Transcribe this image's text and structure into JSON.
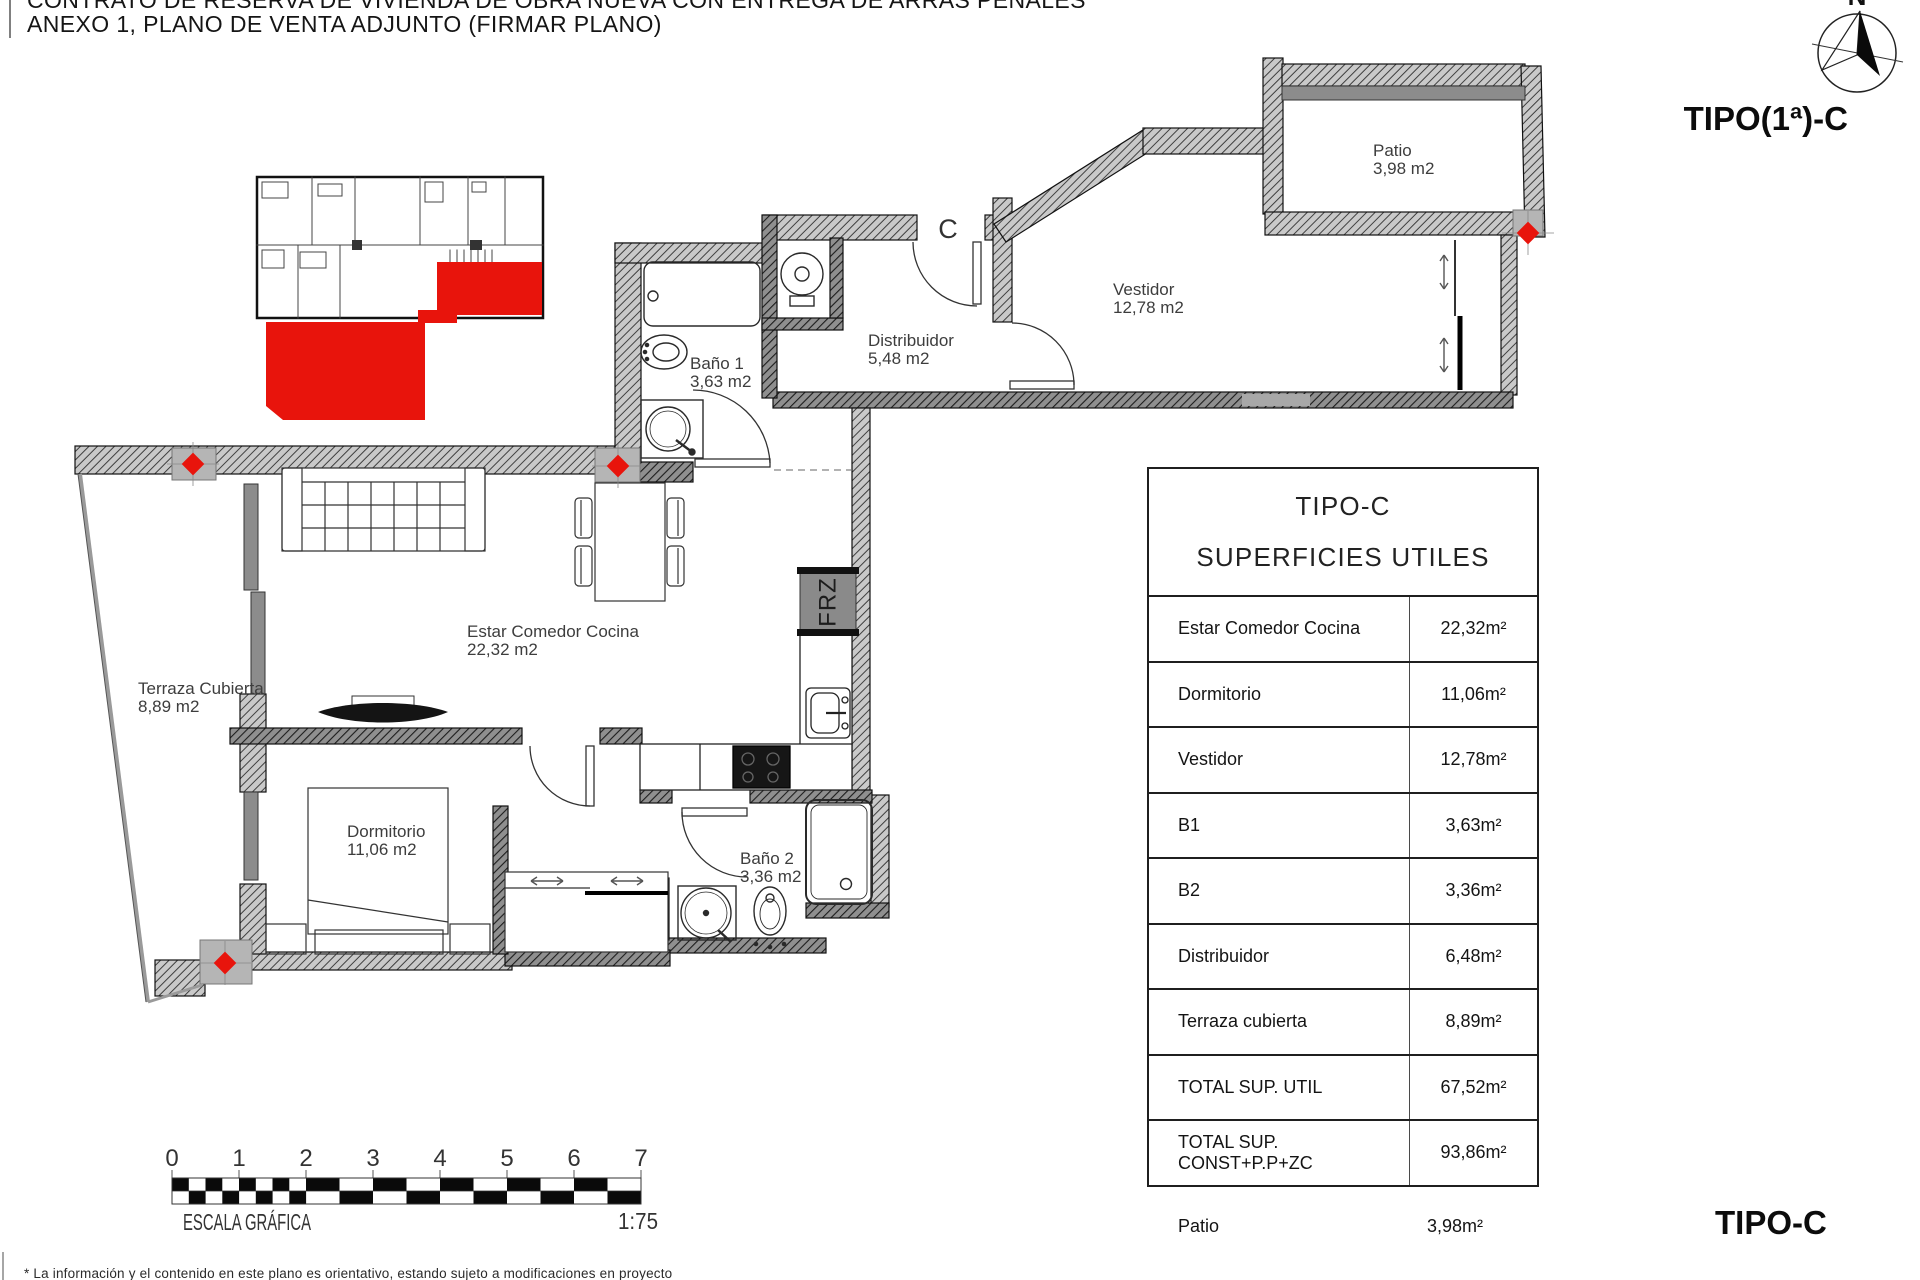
{
  "header": {
    "line1": "CONTRATO DE RESERVA DE VIVIENDA DE OBRA NUEVA CON ENTREGA DE ARRAS PENALES",
    "line2": "ANEXO 1, PLANO DE VENTA ADJUNTO (FIRMAR PLANO)"
  },
  "compass": {
    "north_label": "N"
  },
  "plan": {
    "type_label_top": "TIPO(1ª)-C",
    "type_label_bottom": "TIPO-C",
    "entrance_door_label": "C",
    "fridge_label": "FRZ",
    "rooms": [
      {
        "name": "Patio",
        "area": "3,98 m2"
      },
      {
        "name": "Vestidor",
        "area": "12,78 m2"
      },
      {
        "name": "Distribuidor",
        "area": "5,48 m2"
      },
      {
        "name": "Baño 1",
        "area": "3,63 m2"
      },
      {
        "name": "Estar Comedor Cocina",
        "area": "22,32 m2"
      },
      {
        "name": "Terraza Cubierta",
        "area": "8,89 m2"
      },
      {
        "name": "Dormitorio",
        "area": "11,06 m2"
      },
      {
        "name": "Baño 2",
        "area": "3,36 m2"
      }
    ]
  },
  "table": {
    "title_line1": "TIPO-C",
    "title_line2": "SUPERFICIES UTILES",
    "rows": [
      {
        "label": "Estar Comedor Cocina",
        "value": "22,32m²"
      },
      {
        "label": "Dormitorio",
        "value": "11,06m²"
      },
      {
        "label": "Vestidor",
        "value": "12,78m²"
      },
      {
        "label": "B1",
        "value": "3,63m²"
      },
      {
        "label": "B2",
        "value": "3,36m²"
      },
      {
        "label": "Distribuidor",
        "value": "6,48m²"
      },
      {
        "label": "Terraza cubierta",
        "value": "8,89m²"
      },
      {
        "label": "TOTAL SUP. UTIL",
        "value": "67,52m²"
      },
      {
        "label": "TOTAL SUP. CONST+P.P+ZC",
        "value": "93,86m²"
      }
    ],
    "footer_row": {
      "label": "Patio",
      "value": "3,98m²"
    }
  },
  "scale_bar": {
    "ticks": [
      "0",
      "1",
      "2",
      "3",
      "4",
      "5",
      "6",
      "7"
    ],
    "caption": "ESCALA GRÁFICA",
    "ratio": "1:75"
  },
  "footnote": "* La información y el contenido en este plano es orientativo, estando sujeto a modificaciones en proyecto",
  "colors": {
    "highlight_red": "#e8140c",
    "insulation_yellow": "#f2c41d",
    "wall_gray": "#8c8c8c"
  }
}
